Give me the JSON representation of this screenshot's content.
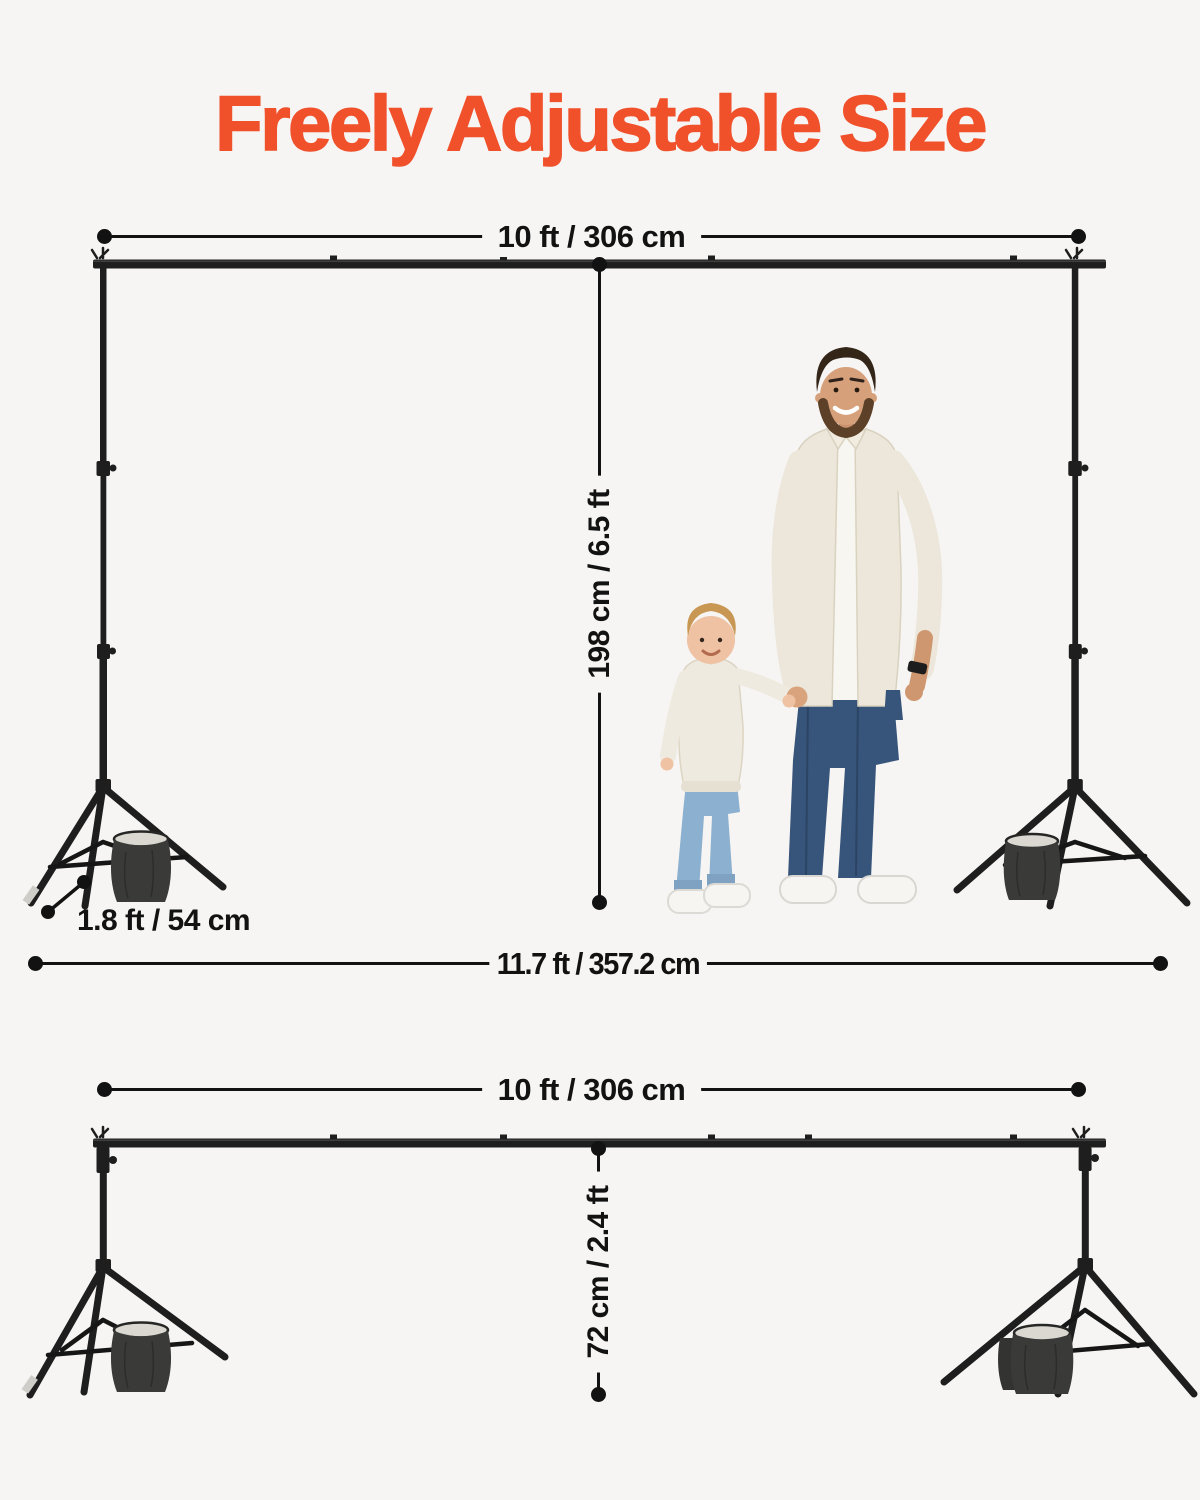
{
  "page": {
    "title": "Freely Adjustable Size"
  },
  "colors": {
    "background": "#f6f5f3",
    "accent": "#f0512b",
    "ink": "#121212",
    "stand": "#1e1e1e",
    "sandbag": "#3a3a38",
    "cream": "#ece7da",
    "jeans_dark": "#37547a",
    "jeans_light": "#8cb0cf",
    "skin_man": "#d6a07b",
    "skin_child": "#eec2a2",
    "hair_man": "#342519",
    "hair_child": "#c89753",
    "shoe_white": "#f6f5f1"
  },
  "top_diagram": {
    "crossbar_width": {
      "label": "10 ft / 306 cm"
    },
    "stand_height": {
      "label": "198 cm / 6.5 ft"
    },
    "leg_spread": {
      "label": "1.8 ft / 54 cm"
    },
    "total_width": {
      "label": "11.7 ft / 357.2 cm"
    }
  },
  "bottom_diagram": {
    "crossbar_width": {
      "label": "10 ft / 306 cm"
    },
    "stand_height": {
      "label": "72 cm / 2.4 ft"
    }
  }
}
